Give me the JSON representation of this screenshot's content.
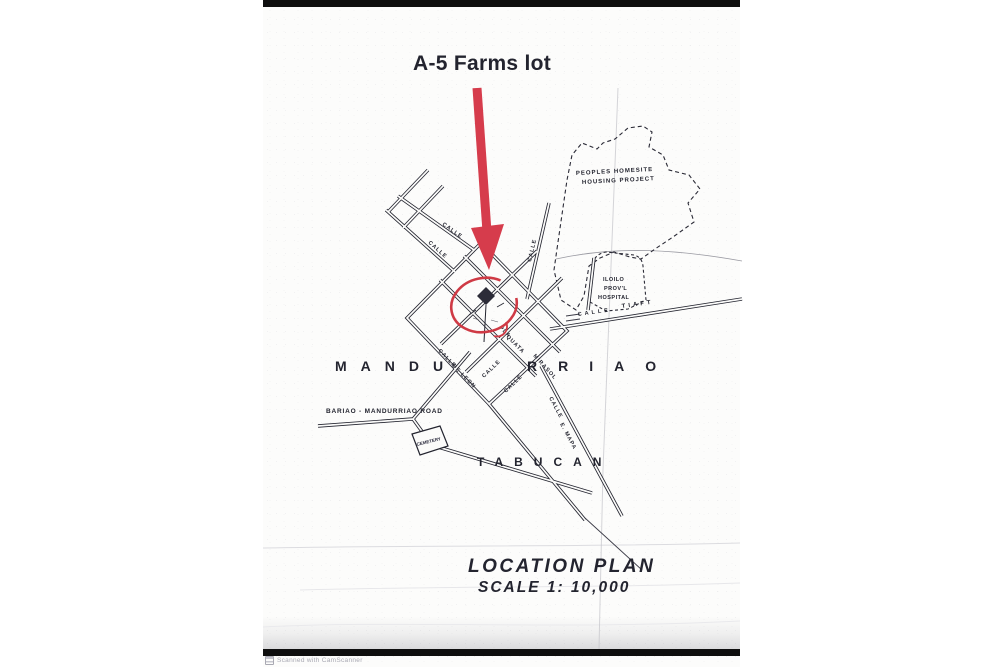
{
  "colors": {
    "annotation_red": "#d63c4c",
    "circle_red": "#cf3a45",
    "map_ink": "#23242f",
    "title_ink": "#2e3252",
    "paper": "#fcfcfb",
    "edge_bar": "#0e0e0e"
  },
  "annotation": {
    "label": "A-5 Farms lot"
  },
  "districts": {
    "mandurriao_part1": "MANDU",
    "mandurriao_part2": "RRIAO",
    "tabucan": "TABUCAN"
  },
  "areas": {
    "homesite_line1": "PEOPLES HOMESITE",
    "homesite_line2": "HOUSING PROJECT",
    "hospital_line1": "ILOILO",
    "hospital_line2": "PROV'L",
    "hospital_line3": "HOSPITAL"
  },
  "roads": {
    "bariao_road": "BARIAO - MANDURRIAO ROAD",
    "cemetery": "CEMETERY",
    "calle_1": "CALLE",
    "calle_2": "CALLE",
    "calle_3": "CALLE",
    "calle_4": "CALLE",
    "de_leon": "DE LEON",
    "calle_5": "CALLE",
    "calle_6": "CALLE",
    "pla": "PLA.",
    "quata": "QUATA",
    "mirasol": "MIRASOL",
    "calle_7": "CALLE",
    "e_mapa": "E. MAPA",
    "calle_8": "CALLE",
    "tiaft": "TIAFT"
  },
  "title_block": {
    "line1": "LOCATION PLAN",
    "line2": "SCALE 1: 10,000"
  },
  "watermark": {
    "label": "Scanned with CamScanner"
  }
}
